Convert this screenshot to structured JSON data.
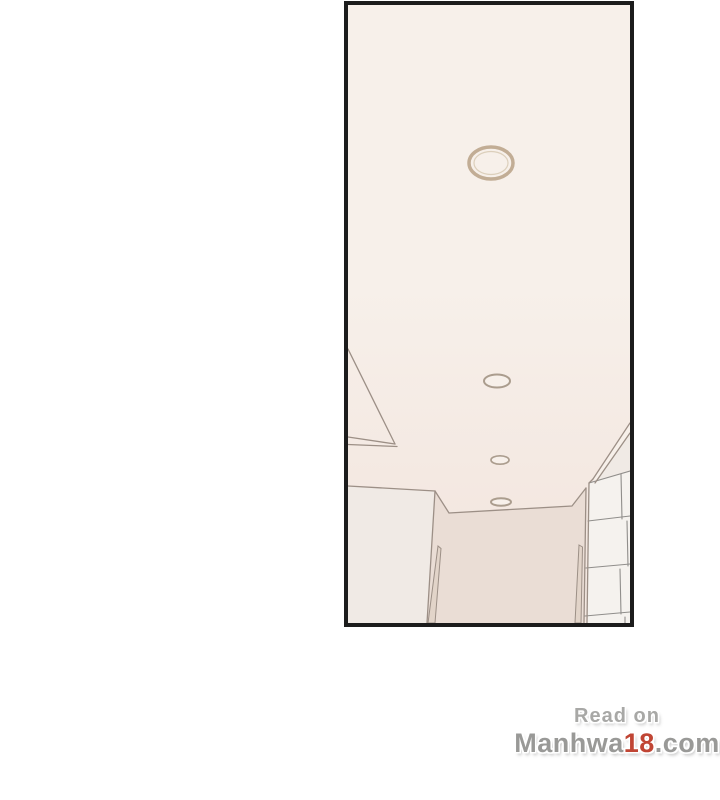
{
  "page": {
    "background": "#ffffff"
  },
  "panel": {
    "border_color": "#1c1c1c",
    "ceiling_color_top": "#f7f0ea",
    "ceiling_color_bottom": "#f3e7e0",
    "left_wall_color": "#f0eae5",
    "far_wall_color": "#eaddd5",
    "frame_color": "#e2d4c9",
    "tile_color": "#f5f2ee",
    "grout_color": "#908e8b",
    "line_color": "#9c8f86",
    "light_ring_color": "#c2ad95",
    "light_ring_inner_color": "#dccfbb",
    "small_ring_color": "#ab9d8e",
    "lights": [
      {
        "cx": 491,
        "cy": 163,
        "rx": 22,
        "ry": 16
      },
      {
        "cx": 497,
        "cy": 381,
        "rx": 13,
        "ry": 6.5
      },
      {
        "cx": 500,
        "cy": 460,
        "rx": 9,
        "ry": 4.2
      },
      {
        "cx": 501,
        "cy": 502,
        "rx": 10,
        "ry": 3.8
      }
    ],
    "lights_inner": [
      {
        "rx": 17,
        "ry": 11.5
      }
    ]
  },
  "watermark": {
    "line1": "Read on",
    "brand": "Manhwa",
    "brand_number": "18",
    "brand_suffix": ".com",
    "line1_color": "#a8a8a6",
    "text_color": "#999997",
    "accent_color": "#c04534"
  }
}
